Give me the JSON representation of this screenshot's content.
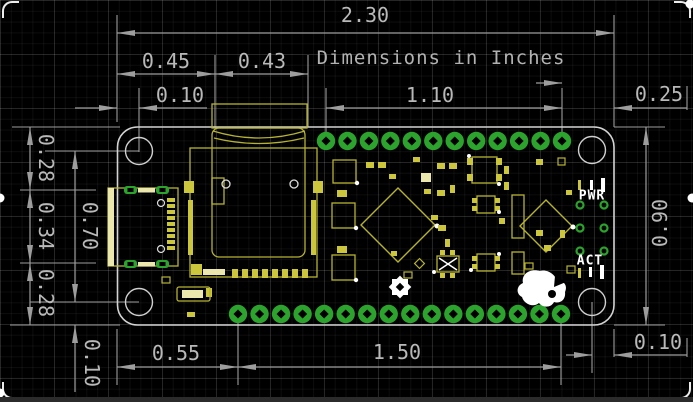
{
  "drawing": {
    "note": "Dimensions in Inches",
    "units": "Inches",
    "dimensions": {
      "board_width": "2.30",
      "left_to_battery_connector": "0.45",
      "battery_connector_width": "0.43",
      "left_edge_to_hole": "0.10",
      "top_header_span": "1.10",
      "last_pad_to_right_edge": "0.25",
      "top_edge_to_usb": "0.28",
      "usb_height": "0.34",
      "usb_to_bottom_edge": "0.28",
      "hole_to_hole_vertical": "0.70",
      "board_height": "0.90",
      "hole_to_bottom_edge": "0.10",
      "left_edge_to_first_bottom_pad": "0.55",
      "bottom_header_span": "1.50",
      "hole_to_right_edge": "0.10"
    },
    "board": {
      "silkscreen_labels": {
        "pwr": "PWR",
        "act": "ACT"
      },
      "top_pad_count": 12,
      "bottom_pad_count": 16,
      "mounting_hole_count": 4
    },
    "colors": {
      "background": "#000000",
      "dimension_gray": "#9d9d9d",
      "text_gray": "#b9b9b9",
      "board_outline": "#d4d4d4",
      "silkscreen_yellow": "#b7b332",
      "silkscreen_fill": "#cbc63c",
      "silkscreen_bright": "#ece7ad",
      "pad_green": "#2ca32c",
      "white": "#ffffff"
    }
  }
}
